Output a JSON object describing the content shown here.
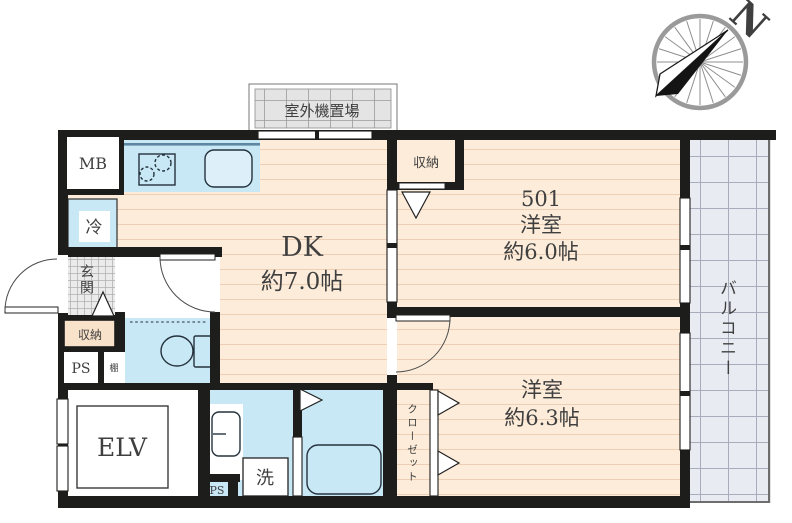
{
  "plan": {
    "compass_label": "N",
    "outdoor_unit_label": "室外機置場",
    "balcony_label": "バルコニー",
    "meter_box_label": "MB",
    "fridge_label": "冷",
    "entrance_label": "玄関",
    "entrance_storage_label": "収納",
    "ps_upper_label": "PS",
    "shelf_label": "棚",
    "dk": {
      "name": "DK",
      "size": "約7.0帖"
    },
    "room_501": {
      "number": "501",
      "type": "洋室",
      "size": "約6.0帖",
      "storage_label": "収納"
    },
    "room_2": {
      "type": "洋室",
      "size": "約6.3帖",
      "closet_label": "クローゼット"
    },
    "elevator_label": "ELV",
    "washer_label": "洗",
    "ps_lower_label": "PS"
  },
  "colors": {
    "wall": "#1d1d1b",
    "floor": "#fcecd9",
    "stripe": "#eccfb4",
    "water": "#c9e8f6",
    "water_line": "#5d87a0",
    "sink": "#ddf0fa",
    "balcony": "#e9ebf2",
    "balcony_line": "#a8adbb",
    "genkan": "#ebebeb",
    "genkan_line": "#b3b3b3",
    "label": "#3f3f3f",
    "fixture": "#24323c"
  }
}
